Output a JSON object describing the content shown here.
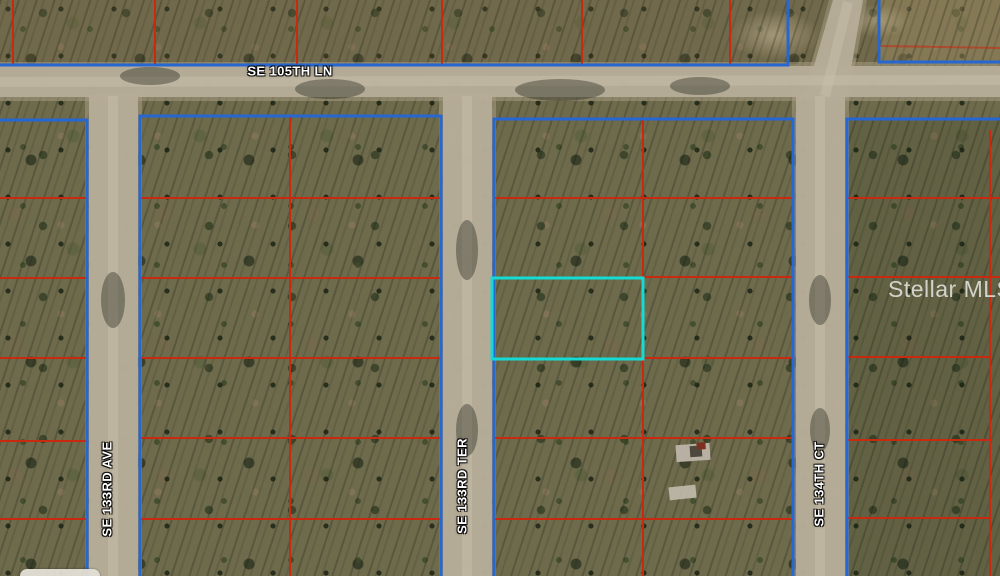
{
  "map": {
    "street_labels": [
      {
        "name": "SE 105TH LN",
        "orientation": "horizontal"
      },
      {
        "name": "SE 133RD AVE",
        "orientation": "vertical"
      },
      {
        "name": "SE 133RD TER",
        "orientation": "vertical"
      },
      {
        "name": "SE 134TH CT",
        "orientation": "vertical"
      }
    ],
    "watermark": "Stellar MLS",
    "colors": {
      "block_outline": "#2767d2",
      "lot_line": "#c9290f",
      "highlight_outline": "#15dbd5",
      "road_fill": "#b6ad99"
    }
  }
}
